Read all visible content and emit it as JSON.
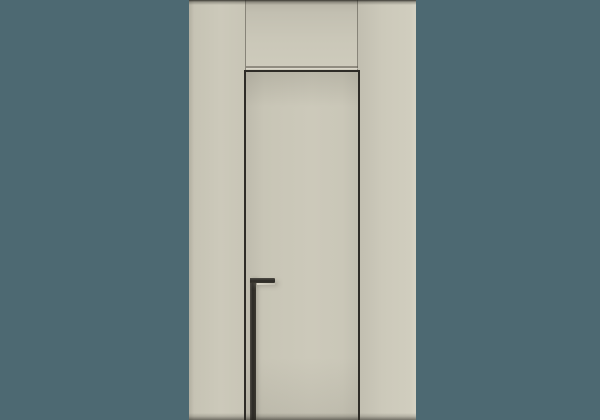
{
  "scene": {
    "description": "Minimalist flush interior door set into beige wall paneling with a black recessed L-shaped edge-pull handle, centered on a plain teal background",
    "colors": {
      "background": "#4D6972",
      "panel": "#CCC9BA",
      "panel-dark": "#B5B2A4",
      "panel-light": "#D6D3C5",
      "seam": "#8F8C80",
      "gap": "#2E2C27",
      "handle-dark": "#2C2A25",
      "handle-mid": "#3A372F",
      "handle-light": "#4E4B44",
      "handle-highlight": "#DCD8CA"
    }
  }
}
